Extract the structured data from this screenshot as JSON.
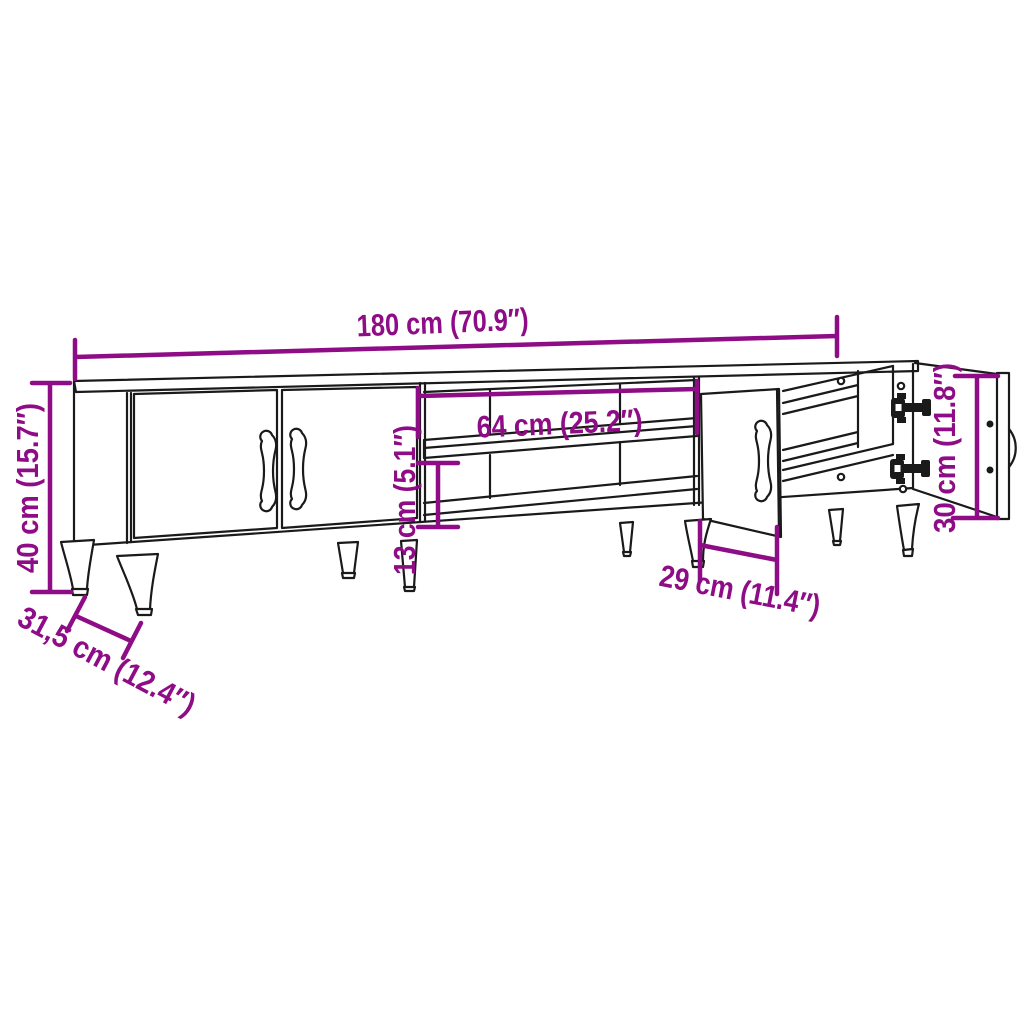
{
  "colors": {
    "dimension": "#8e0c85",
    "line": "#1a1a1a",
    "background": "#ffffff"
  },
  "dimensions": {
    "overall_width": "180 cm (70.9″)",
    "overall_height": "40 cm (15.7″)",
    "overall_depth": "31,5 cm (12.4″)",
    "compartment_width": "64 cm (25.2″)",
    "compartment_height": "13 cm (5.1″)",
    "door_width": "29 cm (11.4″)",
    "door_height": "30 cm (11.8″)"
  }
}
